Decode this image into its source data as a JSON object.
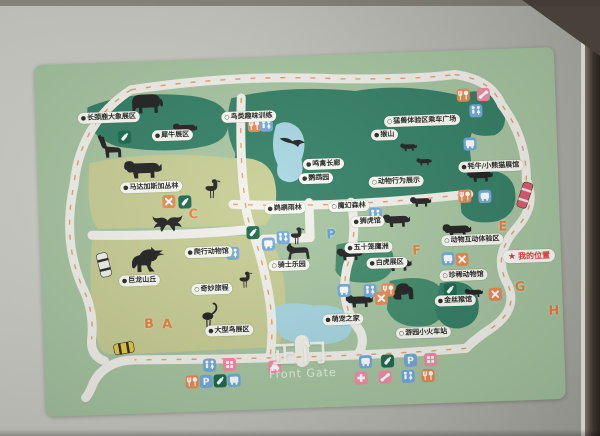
{
  "map": {
    "gate": {
      "title": "正门",
      "subtitle": "Front Gate"
    },
    "my_location": {
      "text": "我的位置",
      "x": 488,
      "y": 208,
      "star": "★"
    },
    "palette": {
      "map_bg": "#a6c5a0",
      "zone_dark": "#2e7c62",
      "zone_mid": "#3c8868",
      "zone_yellow": "#c7cd92",
      "water": "#a5d6e2",
      "road": "#f4f2ec",
      "arrow": "#e09a5a",
      "letter_orange": "#e67e3c",
      "letter_blue": "#5b9bd5"
    },
    "icon_colors": {
      "toilet": "#6fa8dc",
      "bus": "#6fa8dc",
      "parking": "#6fa8dc",
      "food": "#e8874d",
      "x": "#e8874d",
      "feed": "#166549",
      "phone": "#f08ca0",
      "cross": "#f08ca0",
      "grid": "#f08ca0",
      "car": "#f08ca0"
    },
    "labels": [
      {
        "x": 73,
        "y": 55,
        "b": "f",
        "t": "长颈鹿大象展区"
      },
      {
        "x": 136,
        "y": 75,
        "b": "f",
        "t": "犀牛展区"
      },
      {
        "x": 113,
        "y": 126,
        "b": "f",
        "t": "马达加斯加丛林"
      },
      {
        "x": 213,
        "y": 59,
        "b": "o",
        "t": "鸟类趣味训练"
      },
      {
        "x": 386,
        "y": 69,
        "b": "o",
        "t": "猛兽体验区乘车广场"
      },
      {
        "x": 348,
        "y": 82,
        "b": "f",
        "t": "猴山"
      },
      {
        "x": 286,
        "y": 109,
        "b": "f",
        "t": "鸣禽长廊"
      },
      {
        "x": 278,
        "y": 123,
        "b": "f",
        "t": "鹦鹉园"
      },
      {
        "x": 453,
        "y": 117,
        "b": "f",
        "t": "牦牛/小熊猫展馆"
      },
      {
        "x": 358,
        "y": 129,
        "b": "o",
        "t": "动物行为展示"
      },
      {
        "x": 246,
        "y": 152,
        "b": "f",
        "t": "鹈鹕雨林"
      },
      {
        "x": 310,
        "y": 152,
        "b": "o",
        "t": "魔幻森林"
      },
      {
        "x": 328,
        "y": 168,
        "b": "f",
        "t": "狮虎馆"
      },
      {
        "x": 328,
        "y": 194,
        "b": "f",
        "t": "五十笼鹰洲"
      },
      {
        "x": 346,
        "y": 210,
        "b": "f",
        "t": "白虎展区"
      },
      {
        "x": 168,
        "y": 193,
        "b": "f",
        "t": "爬行动物馆"
      },
      {
        "x": 98,
        "y": 219,
        "b": "f",
        "t": "巨龙山丘"
      },
      {
        "x": 170,
        "y": 230,
        "b": "o",
        "t": "奇妙旅程"
      },
      {
        "x": 248,
        "y": 209,
        "b": "o",
        "t": "骑士乐园"
      },
      {
        "x": 186,
        "y": 272,
        "b": "f",
        "t": "大型鸟展区"
      },
      {
        "x": 300,
        "y": 265,
        "b": "f",
        "t": "萌宠之家"
      },
      {
        "x": 380,
        "y": 281,
        "b": "o",
        "t": "游园小火车站"
      },
      {
        "x": 432,
        "y": 190,
        "b": "o",
        "t": "动物互动体验区"
      },
      {
        "x": 422,
        "y": 225,
        "b": "o",
        "t": "珍稀动物馆"
      },
      {
        "x": 413,
        "y": 250,
        "b": "f",
        "t": "金丝猴馆"
      }
    ],
    "letters": [
      {
        "x": 106,
        "y": 263,
        "t": "B",
        "c": "orange"
      },
      {
        "x": 124,
        "y": 264,
        "t": "A",
        "c": "orange"
      },
      {
        "x": 154,
        "y": 155,
        "t": "C",
        "c": "orange"
      },
      {
        "x": 463,
        "y": 178,
        "t": "E",
        "c": "orange"
      },
      {
        "x": 376,
        "y": 199,
        "t": "F",
        "c": "orange"
      },
      {
        "x": 478,
        "y": 239,
        "t": "G",
        "c": "orange"
      },
      {
        "x": 511,
        "y": 264,
        "t": "H",
        "c": "orange"
      },
      {
        "x": 291,
        "y": 180,
        "t": "P",
        "c": "blue"
      }
    ],
    "icons": [
      {
        "x": 218,
        "y": 68,
        "t": "food"
      },
      {
        "x": 230,
        "y": 68,
        "t": "toilet"
      },
      {
        "x": 428,
        "y": 45,
        "t": "food"
      },
      {
        "x": 448,
        "y": 45,
        "t": "phone"
      },
      {
        "x": 440,
        "y": 61,
        "t": "toilet"
      },
      {
        "x": 433,
        "y": 94,
        "t": "bus"
      },
      {
        "x": 88,
        "y": 75,
        "t": "feed"
      },
      {
        "x": 130,
        "y": 141,
        "t": "x"
      },
      {
        "x": 146,
        "y": 142,
        "t": "feed"
      },
      {
        "x": 426,
        "y": 146,
        "t": "food"
      },
      {
        "x": 446,
        "y": 147,
        "t": "bus"
      },
      {
        "x": 336,
        "y": 161,
        "t": "toilet"
      },
      {
        "x": 213,
        "y": 175,
        "t": "feed"
      },
      {
        "x": 243,
        "y": 181,
        "t": "toilet"
      },
      {
        "x": 192,
        "y": 195,
        "t": "toilet"
      },
      {
        "x": 228,
        "y": 187,
        "t": "bus"
      },
      {
        "x": 407,
        "y": 208,
        "t": "bus"
      },
      {
        "x": 421,
        "y": 209,
        "t": "x"
      },
      {
        "x": 302,
        "y": 236,
        "t": "bus"
      },
      {
        "x": 328,
        "y": 237,
        "t": "toilet"
      },
      {
        "x": 346,
        "y": 237,
        "t": "food"
      },
      {
        "x": 339,
        "y": 245,
        "t": "x"
      },
      {
        "x": 408,
        "y": 239,
        "t": "feed"
      },
      {
        "x": 453,
        "y": 245,
        "t": "x"
      },
      {
        "x": 165,
        "y": 306,
        "t": "toilet"
      },
      {
        "x": 185,
        "y": 306,
        "t": "grid"
      },
      {
        "x": 147,
        "y": 322,
        "t": "food"
      },
      {
        "x": 161,
        "y": 322,
        "t": "parking"
      },
      {
        "x": 175,
        "y": 322,
        "t": "feed"
      },
      {
        "x": 189,
        "y": 322,
        "t": "bus"
      },
      {
        "x": 230,
        "y": 310,
        "t": "car"
      },
      {
        "x": 321,
        "y": 308,
        "t": "bus"
      },
      {
        "x": 343,
        "y": 308,
        "t": "feed"
      },
      {
        "x": 366,
        "y": 308,
        "t": "parking"
      },
      {
        "x": 386,
        "y": 308,
        "t": "grid"
      },
      {
        "x": 316,
        "y": 324,
        "t": "cross"
      },
      {
        "x": 340,
        "y": 324,
        "t": "phone"
      },
      {
        "x": 363,
        "y": 324,
        "t": "toilet"
      },
      {
        "x": 383,
        "y": 324,
        "t": "food"
      }
    ],
    "animals": [
      {
        "x": 110,
        "y": 42,
        "t": "elephant",
        "s": 1.1
      },
      {
        "x": 148,
        "y": 69,
        "t": "quad",
        "s": 0.8
      },
      {
        "x": 70,
        "y": 86,
        "t": "giraffe",
        "s": 1.0
      },
      {
        "x": 104,
        "y": 108,
        "t": "quad",
        "s": 1.25
      },
      {
        "x": 173,
        "y": 130,
        "t": "stork",
        "s": 1.0
      },
      {
        "x": 256,
        "y": 180,
        "t": "stork",
        "s": 0.9
      },
      {
        "x": 128,
        "y": 162,
        "t": "bat",
        "s": 1.0
      },
      {
        "x": 108,
        "y": 200,
        "t": "dino",
        "s": 1.3
      },
      {
        "x": 166,
        "y": 258,
        "t": "flamingo",
        "s": 1.1
      },
      {
        "x": 203,
        "y": 222,
        "t": "stork",
        "s": 0.85
      },
      {
        "x": 256,
        "y": 85,
        "t": "birdfly",
        "s": 1.0
      },
      {
        "x": 356,
        "y": 168,
        "t": "quad",
        "s": 0.9
      },
      {
        "x": 308,
        "y": 200,
        "t": "quad",
        "s": 0.85
      },
      {
        "x": 356,
        "y": 212,
        "t": "quad",
        "s": 0.9
      },
      {
        "x": 316,
        "y": 247,
        "t": "quad",
        "s": 0.9
      },
      {
        "x": 381,
        "y": 150,
        "t": "quad",
        "s": 0.7
      },
      {
        "x": 361,
        "y": 238,
        "t": "gorilla",
        "s": 1.0
      },
      {
        "x": 431,
        "y": 243,
        "t": "quad",
        "s": 0.6
      },
      {
        "x": 416,
        "y": 180,
        "t": "quad",
        "s": 0.95
      },
      {
        "x": 441,
        "y": 126,
        "t": "quad",
        "s": 0.85
      },
      {
        "x": 258,
        "y": 195,
        "t": "horse",
        "s": 0.9
      },
      {
        "x": 371,
        "y": 95,
        "t": "quad",
        "s": 0.55
      },
      {
        "x": 386,
        "y": 110,
        "t": "quad",
        "s": 0.5
      }
    ],
    "vehicles": [
      {
        "x": 486,
        "y": 147,
        "w": 10,
        "h": 26,
        "r": 20,
        "c": "#e0566a",
        "t": "tram"
      },
      {
        "x": 63,
        "y": 202,
        "w": 11,
        "h": 24,
        "r": -12,
        "c": "#f2f2ee",
        "t": "striped"
      },
      {
        "x": 80,
        "y": 286,
        "w": 20,
        "h": 11,
        "r": -8,
        "c": "#e8c83a",
        "t": "striped-h"
      }
    ]
  }
}
